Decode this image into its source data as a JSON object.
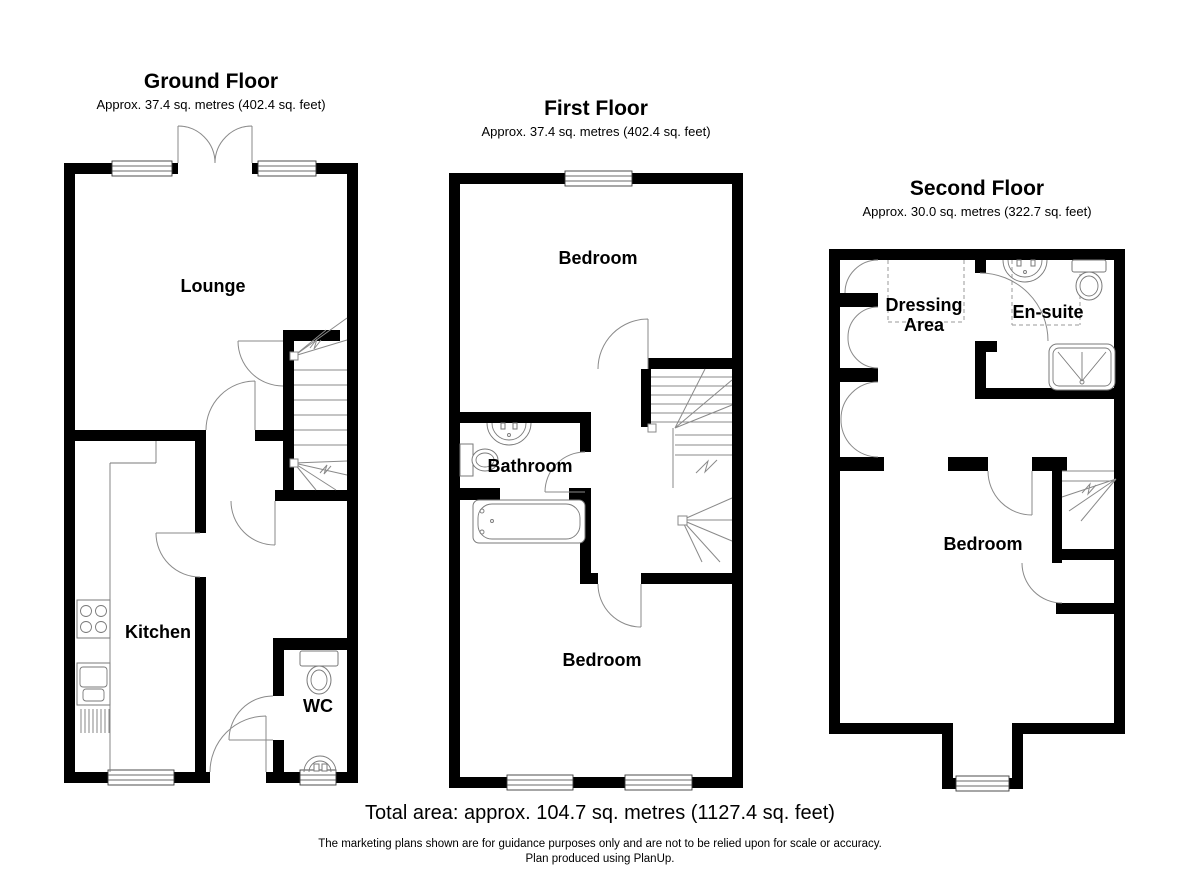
{
  "plan": {
    "floors": [
      {
        "title": "Ground Floor",
        "area": "Approx. 37.4 sq. metres (402.4 sq. feet)",
        "rooms": {
          "lounge": "Lounge",
          "kitchen": "Kitchen",
          "wc": "WC"
        }
      },
      {
        "title": "First Floor",
        "area": "Approx. 37.4 sq. metres (402.4 sq. feet)",
        "rooms": {
          "bedroom_front": "Bedroom",
          "bathroom": "Bathroom",
          "bedroom_back": "Bedroom"
        }
      },
      {
        "title": "Second Floor",
        "area": "Approx. 30.0 sq. metres (322.7 sq. feet)",
        "rooms": {
          "dressing": "Dressing Area",
          "ensuite": "En-suite",
          "bedroom": "Bedroom"
        }
      }
    ],
    "footer": {
      "total": "Total area: approx. 104.7 sq. metres (1127.4 sq. feet)",
      "disclaimer1": "The marketing plans shown are for guidance purposes only and are not to be relied upon for scale or accuracy.",
      "disclaimer2": "Plan produced using PlanUp."
    },
    "colors": {
      "wall": "#000000",
      "detail_line": "#808080"
    }
  }
}
